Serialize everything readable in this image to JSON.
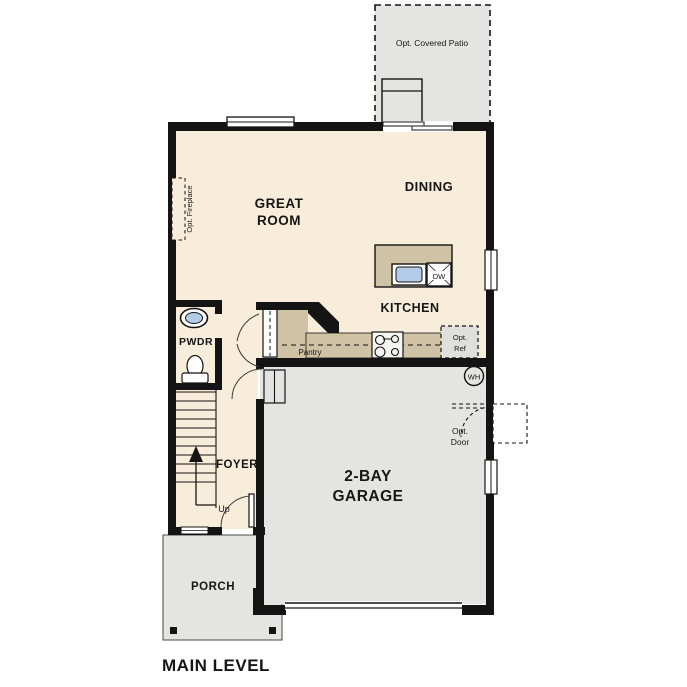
{
  "title": "MAIN LEVEL",
  "labels": {
    "patio": "Opt. Covered Patio",
    "great_room_line1": "GREAT",
    "great_room_line2": "ROOM",
    "dining": "DINING",
    "kitchen": "KITCHEN",
    "fireplace": "Opt. Fireplace",
    "pwdr": "PWDR",
    "pantry": "Pantry",
    "opt_ref_line1": "Opt.",
    "opt_ref_line2": "Ref",
    "dw": "DW",
    "wh": "WH",
    "foyer": "FOYER",
    "up": "Up",
    "garage_line1": "2-BAY",
    "garage_line2": "GARAGE",
    "opt_door_line1": "Opt.",
    "opt_door_line2": "Door",
    "porch": "PORCH"
  },
  "colors": {
    "floor_cream": "#f7edda",
    "floor_gray": "#e4e4e2",
    "counter_tan": "#d0c2a4",
    "sink_blue": "#b3cde8",
    "wall_black": "#141414",
    "background": "#ffffff"
  }
}
